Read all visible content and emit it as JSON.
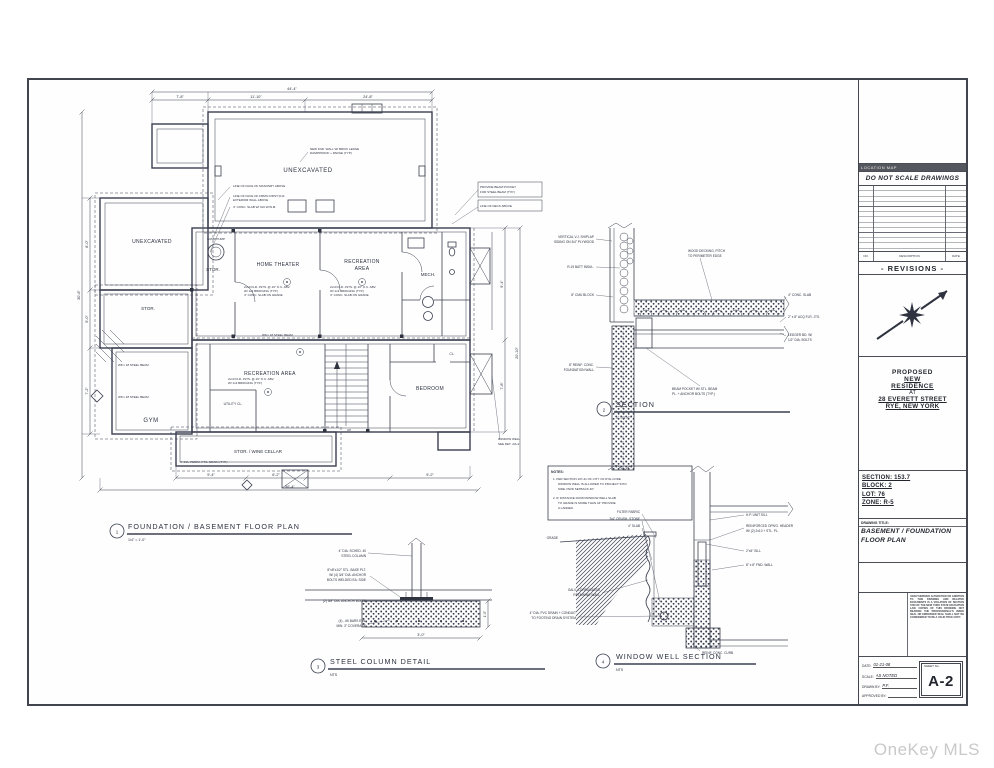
{
  "watermark": "OneKey MLS",
  "titleblock": {
    "location_map": "LOCATION MAP",
    "no_scale": "DO NOT SCALE DRAWINGS",
    "rev_no": "NO.",
    "rev_desc": "DESCRIPTION",
    "rev_date": "DATE",
    "revisions_title": "- REVISIONS -",
    "proposed": "PROPOSED",
    "new_line": "NEW",
    "residence_line": "RESIDENCE",
    "at": "AT",
    "address1": "28 EVERETT STREET",
    "address2": "RYE, NEW YORK",
    "section": "SECTION: 153.7",
    "block": "BLOCK: 2",
    "lot": "LOT: 76",
    "zone": "ZONE: R-5",
    "drawing_title_label": "DRAWING TITLE:",
    "drawing_title1": "BASEMENT / FOUNDATION",
    "drawing_title2": "FLOOR PLAN",
    "disclaimer": "UNAUTHORIZED ALTERATION OR ADDITION TO THIS DRAWING AND RELATED DOCUMENTS IS A VIOLATION OF SECTION 7209 OF THE NEW YORK STATE EDUCATION LAW. COPIES OF THIS DRAWING NOT BEARING THE PROFESSIONAL'S INKED SEAL OR EMBOSSED SEAL SHALL NOT BE CONSIDERED TO BE A VALID TRUE COPY.",
    "date_label": "DATE:",
    "date_value": "01-21-08",
    "scale_label": "SCALE:",
    "scale_value": "AS NOTED",
    "drawn_label": "DRAWN BY:",
    "drawn_value": "P.F.",
    "approved_label": "APPROVED BY:",
    "approved_value": "",
    "sheet_no_label": "SHEET No.",
    "sheet_no": "A-2"
  },
  "plan": {
    "callout": {
      "num": "1",
      "title": "FOUNDATION / BASEMENT FLOOR PLAN",
      "scale": "1/4\" = 1'-0\""
    },
    "rooms": [
      {
        "label": "UNEXCAVATED"
      },
      {
        "label": "UNEXCAVATED"
      },
      {
        "label": "STOR."
      },
      {
        "label": "HOME THEATER"
      },
      {
        "label": "RECREATION",
        "label2": "AREA"
      },
      {
        "label": "MECH."
      },
      {
        "label": "STOR."
      },
      {
        "label": "RECREATION AREA"
      },
      {
        "label": "GYM"
      },
      {
        "label": "UTILITY CL."
      },
      {
        "label": "BEDROOM"
      },
      {
        "label": "STOR. / WINE CELLAR"
      },
      {
        "label": "CL."
      },
      {
        "label": "SUMP PUMP"
      }
    ],
    "notes": {
      "n1a": "LINE OF FACE OF MASONRY ABOVE",
      "n1b": "LINE OF FACE OF FRM'D FIRST FLR.",
      "n1c": "EXTERIOR WALL ABOVE",
      "n1d": "4\" CONC. SLAB W/ 6x6 W.W.M.",
      "n2a": "NEW FND. WALL W/ BRICK LEDGE",
      "n2b": "DAMPPROOF + PARGE (TYP.)",
      "n3a": "PROVIDE BEAM POCKET",
      "n3b": "FOR STEEL BEAM (TYP.)",
      "n3c": "LINE OF DECK ABOVE",
      "n4": "W8 x 18 STEEL BEAM",
      "n5": "4\" DIA. PERIM. FTG. DRAIN (TYP.)",
      "n6a": "WINDOW WELL",
      "n6b": "SEE DET. 4/A-2",
      "s1": "2x10 FLR. JSTS. @ 16\" O.C. ABV.",
      "s2": "W/ 1x3 BRIDGING (TYP.)",
      "s3": "4\" CONC. SLAB ON GRADE",
      "up": "UP"
    },
    "dims": [
      "7'-8\"",
      "11'-10\"",
      "24'-8\"",
      "44'-4\"",
      "8'-0\"",
      "5'-0\"",
      "7'-2\"",
      "30'-6\"",
      "9'-4\"",
      "7'-8\"",
      "20'-10\"",
      "9'-4\"",
      "6'-2\"",
      "9'-2\"",
      "56'-4\""
    ]
  },
  "section": {
    "callout": {
      "num": "2",
      "title": "SECTION",
      "scale": "1\" = 1'-0\""
    },
    "l1a": "VERTICAL V.J. SHIPLAP",
    "l1b": "SIDING ON 3/4\" PLYWOOD",
    "l2": "R-19 BATT INSUL.",
    "l3": "8\" CMU BLOCK",
    "l4a": "8\" REINF. CONC.",
    "l4b": "FOUNDATION WALL",
    "r1a": "WOOD DECKING, PITCH",
    "r1b": "TO PERIMETER EDGE",
    "r2": "4\" CONC. SLAB",
    "r3": "2\" x 8\" ACQ FLR. JTS.",
    "r4a": "LEDGER BD. W/",
    "r4b": "1/2\" DIA. BOLTS",
    "r5a": "BEAM POCKET W/ STL. BEAM",
    "r5b": "PL. + ANCHOR BOLTS (TYP.)"
  },
  "column": {
    "callout": {
      "num": "3",
      "title": "STEEL COLUMN DETAIL",
      "scale": "NTS"
    },
    "c1a": "4\" DIA. SCHED. 40",
    "c1b": "STEEL COLUMN",
    "c2a": "8\"x8\"x1/2\" STL. BASE PLT.",
    "c2b": "W/ (4) 3/4\" DIA. ANCHOR",
    "c2c": "BOLTS WELDED EA. SIDE",
    "c3": "(2) 5/8\" DIA. ANCHOR BOLTS",
    "c4a": "(4) - #5 BARS E.W.",
    "c4b": "MIN. 3\" COVERAGE",
    "d1": "3'-0\"",
    "d2": "1'-0\""
  },
  "well": {
    "callout": {
      "num": "4",
      "title": "WINDOW WELL SECTION",
      "scale": "NTS"
    },
    "notes_title": "NOTES:",
    "n1a": "1.  PER SECTION 197-41 OF CITY OF RYE CODE",
    "n1b": "WINDOW WELL IS ALLOWED TO PROJECT INTO",
    "n1c": "SIDE YARD SETBACK 40\".",
    "n2a": "2.  IF DISTANCE FROM WINDOW WELL SLAB",
    "n2b": "TO GRADE IS MORE THAN 44\" PROVIDE",
    "n2c": "A LADDER.",
    "l1": "FILTER FABRIC",
    "l2": "3/4\" CRUSH. STONE",
    "l3": "4\" SLAB",
    "grade": "GRADE",
    "l4a": "GALV. CORRUGATED",
    "l4b": "RETAINING WALL",
    "l5a": "4\" DIA. PVC DRAIN + CONDUIT",
    "l5b": "TO FOOTING DRAIN SYSTEM",
    "r1": "H.P. UNIT SILL",
    "r2a": "REINFORCED OPN'G. HEADER",
    "r2b": "W/ (2) 2x10 + STL. PL.",
    "r3": "2\"x6\" SILL",
    "r4": "8\" x 8\" FND. WALL",
    "r5": "REINF. CONC. CURB"
  }
}
